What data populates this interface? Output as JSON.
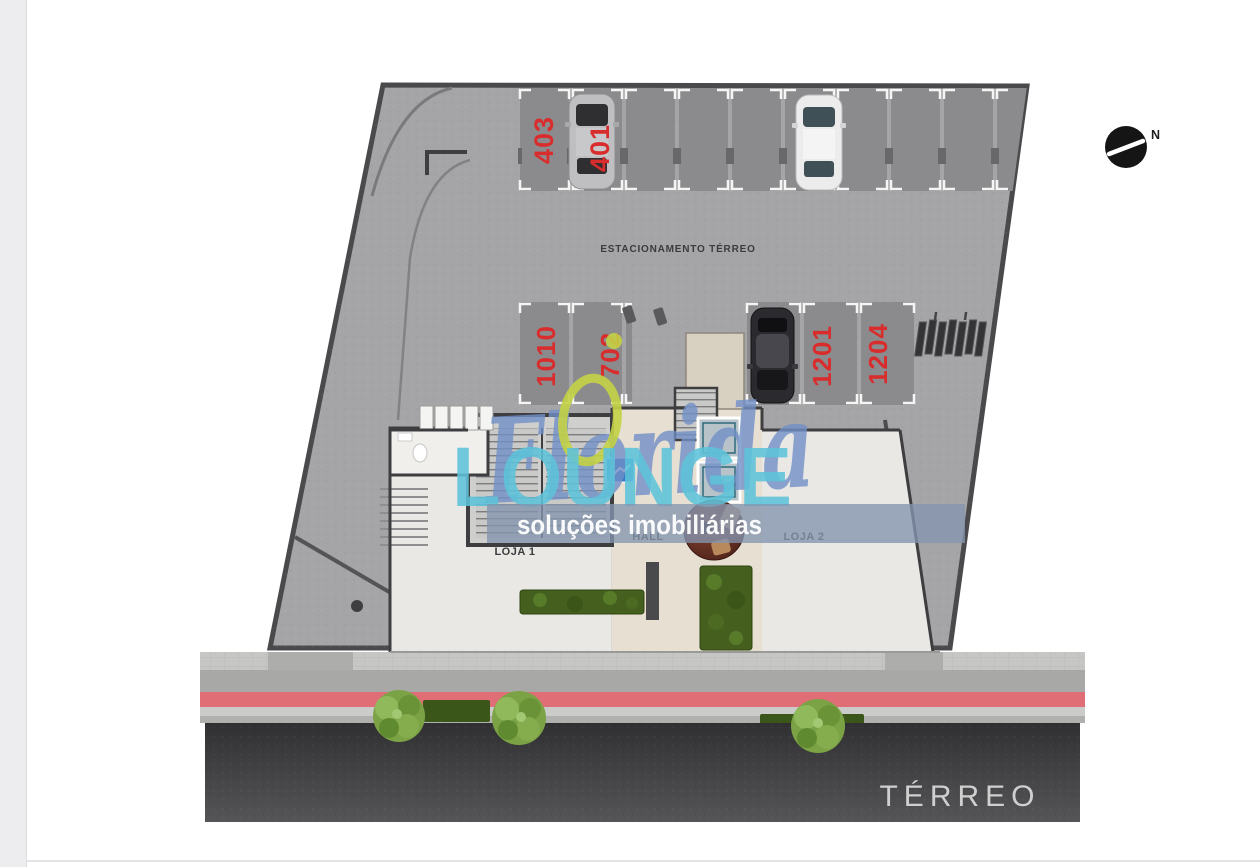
{
  "plan": {
    "floor_label": "TÉRREO",
    "parking_area_label": "ESTACIONAMENTO TÉRREO",
    "compass_label": "N",
    "room_labels": {
      "loja1": "LOJA 1",
      "hall": "HALL",
      "loja2": "LOJA 2"
    },
    "parking_spots": [
      {
        "number": "403"
      },
      {
        "number": "401"
      },
      {
        "number": "1010"
      },
      {
        "number": "702"
      },
      {
        "number": "1201"
      },
      {
        "number": "1204"
      }
    ],
    "colors": {
      "spot_number_red": "#d92c2c",
      "cycle_lane_red": "#e06e77",
      "pavement_gray": "#a5a5a7",
      "spot_gray": "#8b8b8d",
      "road_dark": "#3a3a3c",
      "tree_green": "#7ba345"
    }
  },
  "watermark": {
    "brand_script": "Florida",
    "brand_word": "LOUNGE",
    "tagline": "soluções imobiliárias",
    "colors": {
      "script_blue": "#7290c7",
      "word_blue": "#5ec3da",
      "band_blue_gray": "#8495ae",
      "ring_yellow": "#c3d245"
    }
  }
}
